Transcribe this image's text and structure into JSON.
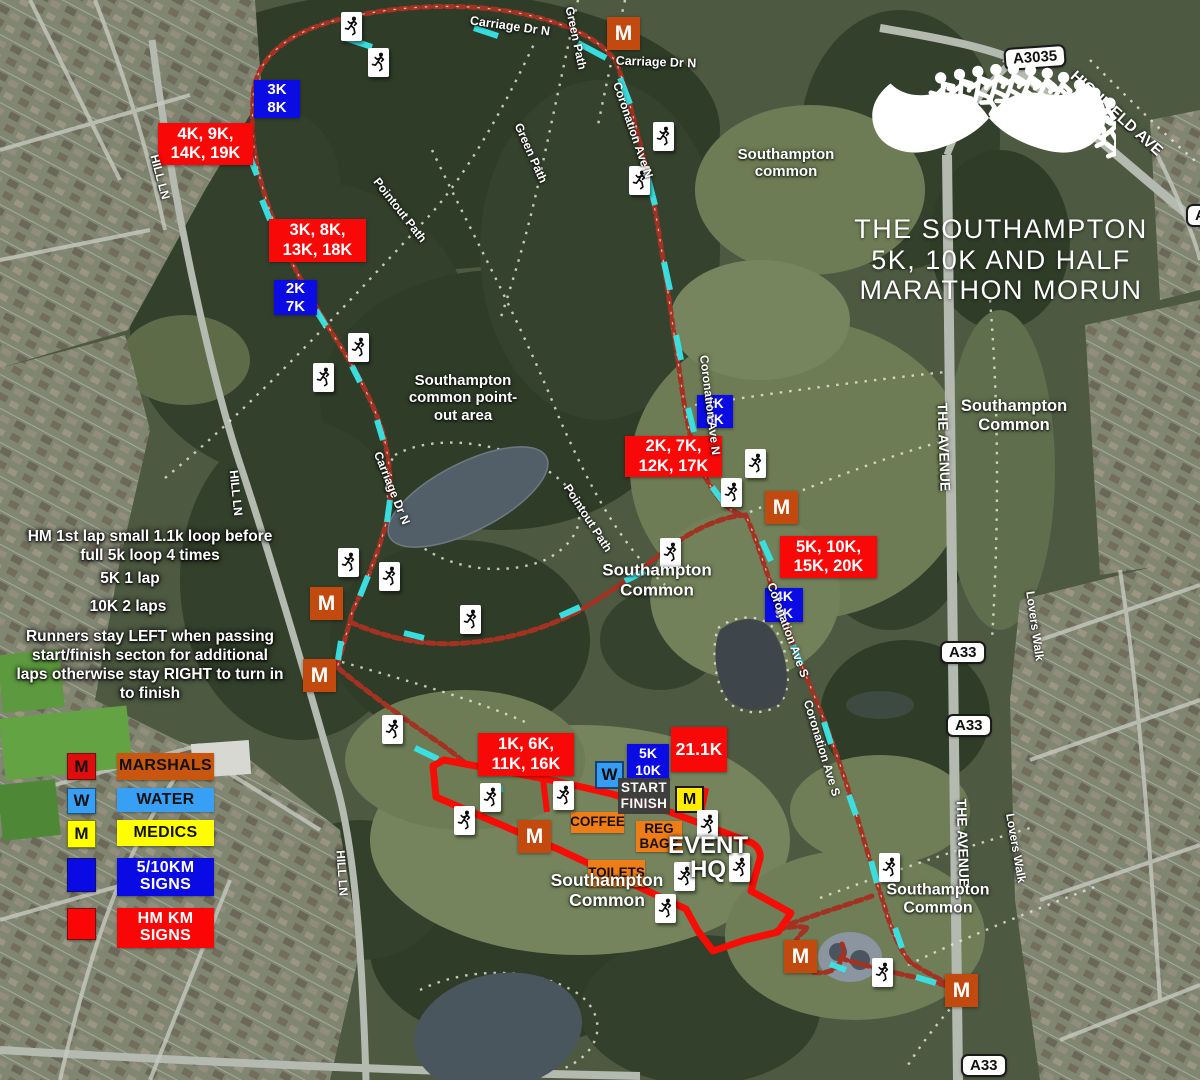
{
  "title": {
    "lines": [
      "THE SOUTHAMPTON",
      "5K, 10K AND HALF",
      "MARATHON MORUN"
    ]
  },
  "instructions": {
    "block1": "HM 1st lap small 1.1k loop before\nfull 5k loop 4 times",
    "lap_5k": "5K 1 lap",
    "lap_10k": "10K 2 laps",
    "block2": "Runners stay LEFT when passing\nstart/finish secton for additional\nlaps otherwise stay RIGHT to turn in\nto finish"
  },
  "legend": {
    "items": [
      {
        "label": "MARSHALS",
        "letter": "M",
        "y": 753,
        "sh": 25,
        "bh": 27,
        "swatch": "#e00d0d",
        "swatch_text": "#111111",
        "bar": "#c9560f",
        "bar_text": "#111111"
      },
      {
        "label": "WATER",
        "letter": "W",
        "y": 788,
        "sh": 24,
        "bh": 24,
        "swatch": "#38a0f4",
        "swatch_text": "#111111",
        "bar": "#38a0f4",
        "bar_text": "#111111"
      },
      {
        "label": "MEDICS",
        "letter": "M",
        "y": 820,
        "sh": 26,
        "bh": 26,
        "swatch": "#ffff00",
        "swatch_text": "#111111",
        "bar": "#ffff00",
        "bar_text": "#111111"
      },
      {
        "label": "5/10KM\nSIGNS",
        "letter": "",
        "y": 858,
        "sh": 32,
        "bh": 38,
        "swatch": "#0a0ae4",
        "swatch_text": "#ffffff",
        "bar": "#0a0ae4",
        "bar_text": "#ffffff"
      },
      {
        "label": "HM KM\nSIGNS",
        "letter": "",
        "y": 908,
        "sh": 30,
        "bh": 40,
        "swatch": "#fb0606",
        "swatch_text": "#ffffff",
        "bar": "#fb0606",
        "bar_text": "#ffffff"
      }
    ]
  },
  "map": {
    "start_finish": "START\nFINISH",
    "event_hq": "EVENT\nHQ",
    "marshal_letter": "M",
    "water_letter": "W",
    "medic_letter": "M",
    "hm_km_signs": [
      {
        "text": "4K, 9K,\n14K, 19K",
        "x": 158,
        "y": 123,
        "w": 95,
        "h": 42
      },
      {
        "text": "3K, 8K,\n13K, 18K",
        "x": 269,
        "y": 219,
        "w": 97,
        "h": 43
      },
      {
        "text": "2K, 7K,\n12K, 17K",
        "x": 625,
        "y": 436,
        "w": 97,
        "h": 41
      },
      {
        "text": "5K, 10K,\n15K, 20K",
        "x": 780,
        "y": 536,
        "w": 97,
        "h": 42
      },
      {
        "text": "1K, 6K,\n11K, 16K",
        "x": 478,
        "y": 733,
        "w": 96,
        "h": 43
      },
      {
        "text": "21.1K",
        "x": 671,
        "y": 727,
        "w": 56,
        "h": 45,
        "size": 17.5
      }
    ],
    "km_510_signs": [
      {
        "text": "3K\n8K",
        "x": 254,
        "y": 80,
        "w": 46,
        "h": 38
      },
      {
        "text": "2K\n7K",
        "x": 274,
        "y": 280,
        "w": 43,
        "h": 35
      },
      {
        "text": "1K\n6K",
        "x": 697,
        "y": 395,
        "w": 36,
        "h": 33,
        "size": 13.5
      },
      {
        "text": "4K\n9K",
        "x": 765,
        "y": 588,
        "w": 38,
        "h": 34,
        "size": 14
      },
      {
        "text": "5K\n10K",
        "x": 627,
        "y": 744,
        "w": 42,
        "h": 36,
        "size": 14
      }
    ],
    "marshals": [
      {
        "x": 607,
        "y": 17
      },
      {
        "x": 765,
        "y": 491
      },
      {
        "x": 310,
        "y": 587
      },
      {
        "x": 303,
        "y": 659
      },
      {
        "x": 518,
        "y": 820
      },
      {
        "x": 784,
        "y": 940
      },
      {
        "x": 945,
        "y": 974
      }
    ],
    "water_stations": [
      {
        "x": 595,
        "y": 761
      }
    ],
    "medic_stations": [
      {
        "x": 675,
        "y": 786
      }
    ],
    "facilities": [
      {
        "text": "COFFEE",
        "x": 571,
        "y": 812,
        "w": 53,
        "h": 21
      },
      {
        "text": "REG\nBAGS",
        "x": 636,
        "y": 821,
        "w": 46,
        "h": 31
      },
      {
        "text": "TOILETS",
        "x": 588,
        "y": 860,
        "w": 57,
        "h": 27
      }
    ],
    "runners": [
      {
        "x": 341,
        "y": 12
      },
      {
        "x": 368,
        "y": 48
      },
      {
        "x": 653,
        "y": 122
      },
      {
        "x": 629,
        "y": 166
      },
      {
        "x": 348,
        "y": 333
      },
      {
        "x": 313,
        "y": 363
      },
      {
        "x": 338,
        "y": 548
      },
      {
        "x": 379,
        "y": 562
      },
      {
        "x": 460,
        "y": 605
      },
      {
        "x": 660,
        "y": 538
      },
      {
        "x": 745,
        "y": 449
      },
      {
        "x": 721,
        "y": 478
      },
      {
        "x": 382,
        "y": 715
      },
      {
        "x": 480,
        "y": 783
      },
      {
        "x": 553,
        "y": 781
      },
      {
        "x": 454,
        "y": 806
      },
      {
        "x": 697,
        "y": 810
      },
      {
        "x": 729,
        "y": 853
      },
      {
        "x": 674,
        "y": 862
      },
      {
        "x": 655,
        "y": 894
      },
      {
        "x": 879,
        "y": 853
      },
      {
        "x": 872,
        "y": 958
      }
    ],
    "road_signs": [
      {
        "text": "A3035",
        "x": 1004,
        "y": 46,
        "rotate": -4
      },
      {
        "text": "A33",
        "x": 940,
        "y": 641
      },
      {
        "text": "A33",
        "x": 946,
        "y": 714
      },
      {
        "text": "A33",
        "x": 961,
        "y": 1054
      },
      {
        "text": "A33",
        "x": 1186,
        "y": 204
      }
    ],
    "road_labels": [
      {
        "text": "Pointout Path",
        "cx": 400,
        "cy": 210,
        "rotate": 52
      },
      {
        "text": "Pointout Path",
        "cx": 588,
        "cy": 518,
        "rotate": 57
      },
      {
        "text": "Carriage Dr N",
        "cx": 510,
        "cy": 26,
        "rotate": 8,
        "size": 12.5
      },
      {
        "text": "Carriage Dr N",
        "cx": 656,
        "cy": 62,
        "rotate": 2,
        "size": 12.5
      },
      {
        "text": "Carriage Dr N",
        "cx": 392,
        "cy": 488,
        "rotate": 68
      },
      {
        "text": "Coronation Ave N",
        "cx": 633,
        "cy": 130,
        "rotate": 71
      },
      {
        "text": "Coronation Ave N",
        "cx": 710,
        "cy": 405,
        "rotate": 83
      },
      {
        "text": "Coronation Ave S",
        "cx": 788,
        "cy": 630,
        "rotate": 70
      },
      {
        "text": "Coronation Ave S",
        "cx": 822,
        "cy": 748,
        "rotate": 73
      },
      {
        "text": "Green Path",
        "cx": 576,
        "cy": 38,
        "rotate": 78
      },
      {
        "text": "Green Path",
        "cx": 531,
        "cy": 153,
        "rotate": 66
      },
      {
        "text": "HILL LN",
        "cx": 160,
        "cy": 177,
        "rotate": 75
      },
      {
        "text": "HILL LN",
        "cx": 236,
        "cy": 493,
        "rotate": 84
      },
      {
        "text": "HILL LN",
        "cx": 342,
        "cy": 873,
        "rotate": 86
      },
      {
        "text": "THE AVENUE",
        "cx": 944,
        "cy": 447,
        "rotate": 88,
        "size": 14
      },
      {
        "text": "THE AVENUE",
        "cx": 963,
        "cy": 843,
        "rotate": 88,
        "size": 14
      },
      {
        "text": "Lovers Walk",
        "cx": 1035,
        "cy": 626,
        "rotate": 82
      },
      {
        "text": "Lovers Walk",
        "cx": 1016,
        "cy": 848,
        "rotate": 80
      },
      {
        "text": "HIGHFIELD AVE",
        "cx": 1116,
        "cy": 114,
        "rotate": 42,
        "size": 15.5
      }
    ],
    "area_labels": [
      {
        "text": "Southampton\ncommon",
        "cx": 786,
        "cy": 163,
        "size": 15
      },
      {
        "text": "Southampton\nCommon",
        "cx": 1014,
        "cy": 416,
        "size": 16.5
      },
      {
        "text": "Southampton\ncommon point-\nout area",
        "cx": 463,
        "cy": 398,
        "size": 15
      },
      {
        "text": "Southampton\nCommon",
        "cx": 657,
        "cy": 580,
        "size": 17
      },
      {
        "text": "Southampton\nCommon",
        "cx": 607,
        "cy": 890,
        "size": 17.5
      },
      {
        "text": "Southampton\nCommon",
        "cx": 938,
        "cy": 900,
        "size": 16
      }
    ]
  },
  "colors": {
    "route_red": "#a43222",
    "chute_red": "#f60d05",
    "cyan_dash": "#38e6e8",
    "marshal_orange": "#c24a0e",
    "water_blue": "#359ef3",
    "medic_yellow": "#ffec00",
    "km_sign_blue": "#0b0be4",
    "km_sign_red": "#f90808",
    "facility_orange": "#ee7d18",
    "start_finish_gray": "#3c3c3c"
  }
}
